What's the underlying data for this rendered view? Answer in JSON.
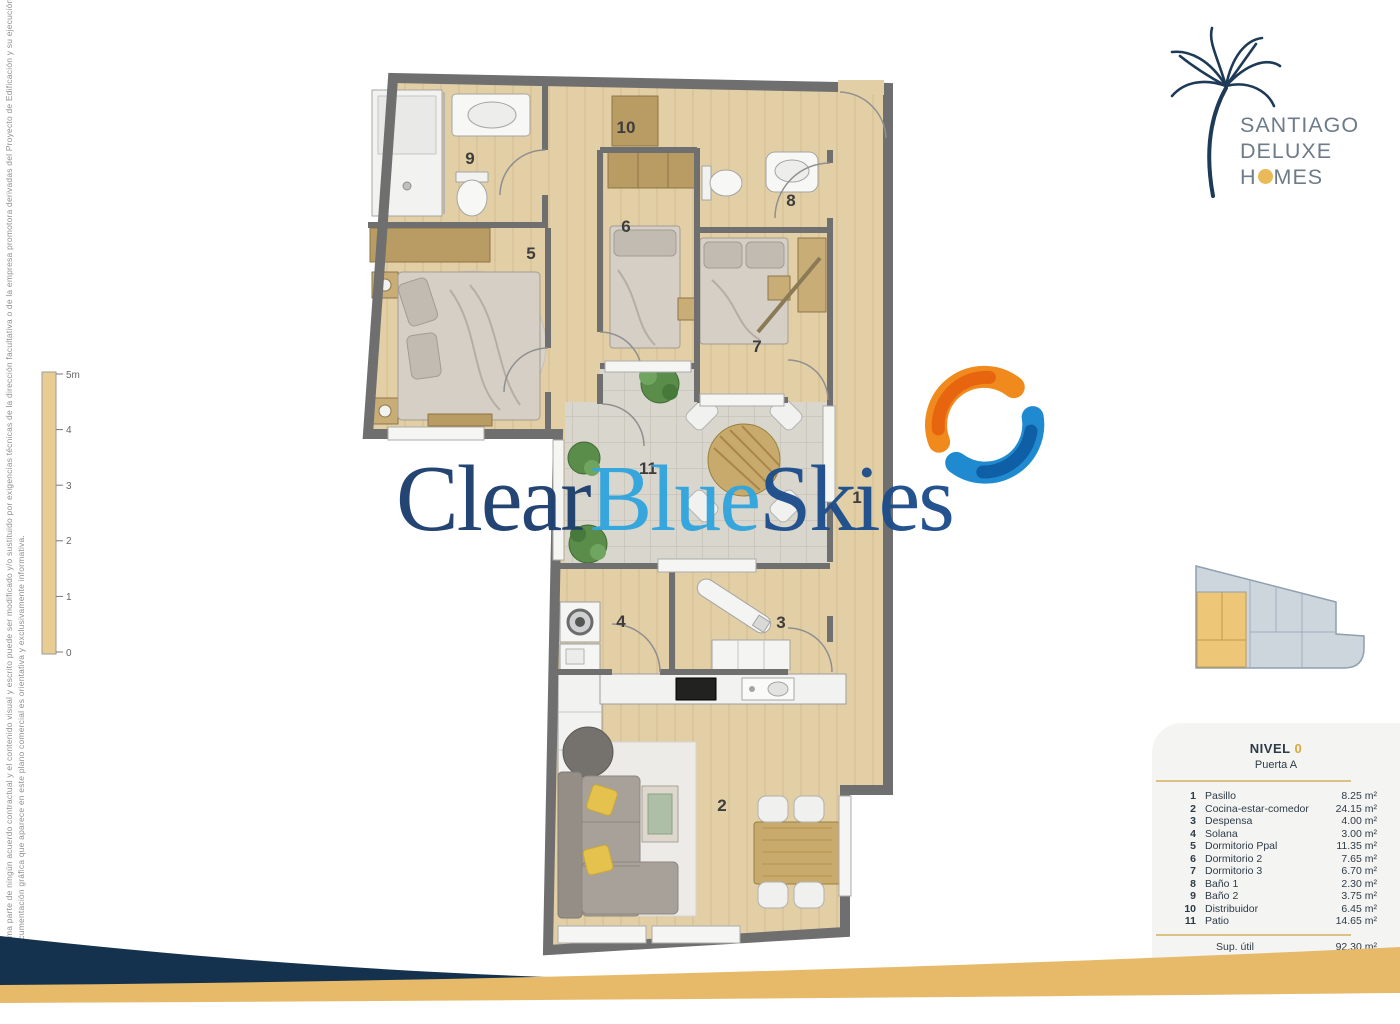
{
  "brand": {
    "line1": "SANTIAGO",
    "line2": "DELUXE",
    "homes_pre": "H",
    "homes_post": "MES",
    "navy": "#1d3a57",
    "gold": "#e9ba57",
    "text_gray": "#6e7b88"
  },
  "watermark": {
    "part1": "Clear",
    "part2": "Blue",
    "part3": "Skies",
    "color_dark": "#1c3e6e",
    "color_light": "#31a5de",
    "color_mid": "#1c4d8c"
  },
  "legend": {
    "level_label": "NIVEL",
    "level_number": "0",
    "door": "Puerta A",
    "rows": [
      {
        "num": "1",
        "name": "Pasillo",
        "area": "8.25 m²"
      },
      {
        "num": "2",
        "name": "Cocina-estar-comedor",
        "area": "24.15 m²"
      },
      {
        "num": "3",
        "name": "Despensa",
        "area": "4.00 m²"
      },
      {
        "num": "4",
        "name": "Solana",
        "area": "3.00 m²"
      },
      {
        "num": "5",
        "name": "Dormitorio Ppal",
        "area": "11.35 m²"
      },
      {
        "num": "6",
        "name": "Dormitorio 2",
        "area": "7.65 m²"
      },
      {
        "num": "7",
        "name": "Dormitorio 3",
        "area": "6.70 m²"
      },
      {
        "num": "8",
        "name": "Baño 1",
        "area": "2.30 m²"
      },
      {
        "num": "9",
        "name": "Baño 2",
        "area": "3.75 m²"
      },
      {
        "num": "10",
        "name": "Distribuidor",
        "area": "6.45 m²"
      },
      {
        "num": "11",
        "name": "Patio",
        "area": "14.65 m²"
      }
    ],
    "totals": [
      {
        "label": "Sup. útil",
        "value": "92.30 m²"
      },
      {
        "label": "Sup. construida",
        "value": "108.45 m²"
      }
    ]
  },
  "scale": {
    "labels": [
      "5m",
      "4",
      "3",
      "2",
      "1",
      "0"
    ]
  },
  "disclaimer": {
    "line_inner": "La documentación gráfica que aparece en este plano comercial es orientativa y exclusivamente informativa.",
    "line_outer": "No forma parte de ningún acuerdo contractual y el contenido visual y escrito puede ser modificado y/o sustituido por exigencias técnicas de la dirección facultativa o de la empresa promotora derivadas del Proyecto de Edificación y su ejecución."
  },
  "plan": {
    "rooms": [
      {
        "num": "1"
      },
      {
        "num": "2"
      },
      {
        "num": "3"
      },
      {
        "num": "4"
      },
      {
        "num": "5"
      },
      {
        "num": "6"
      },
      {
        "num": "7"
      },
      {
        "num": "8"
      },
      {
        "num": "9"
      },
      {
        "num": "10"
      },
      {
        "num": "11"
      }
    ],
    "colors": {
      "wall": "#6f6f6f",
      "wood": "#e3cfa6",
      "tile": "#d9d6cd",
      "footer_navy": "#14314d",
      "footer_gold": "#e7ba6a"
    }
  }
}
